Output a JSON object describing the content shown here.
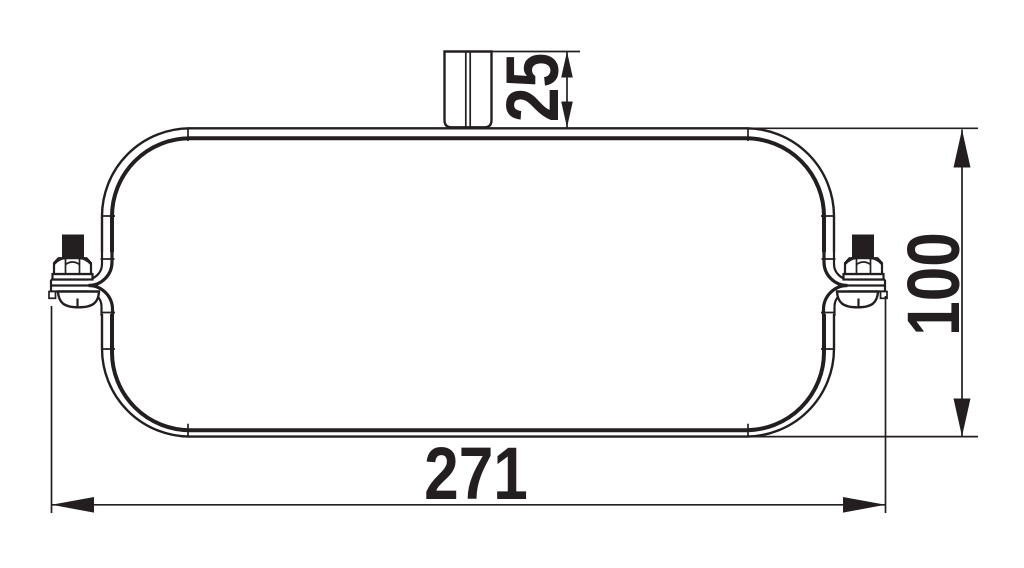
{
  "drawing": {
    "background_color": "#ffffff",
    "line_color": "#231f20",
    "labels": {
      "width": "271",
      "height": "100",
      "stud": "25"
    }
  }
}
